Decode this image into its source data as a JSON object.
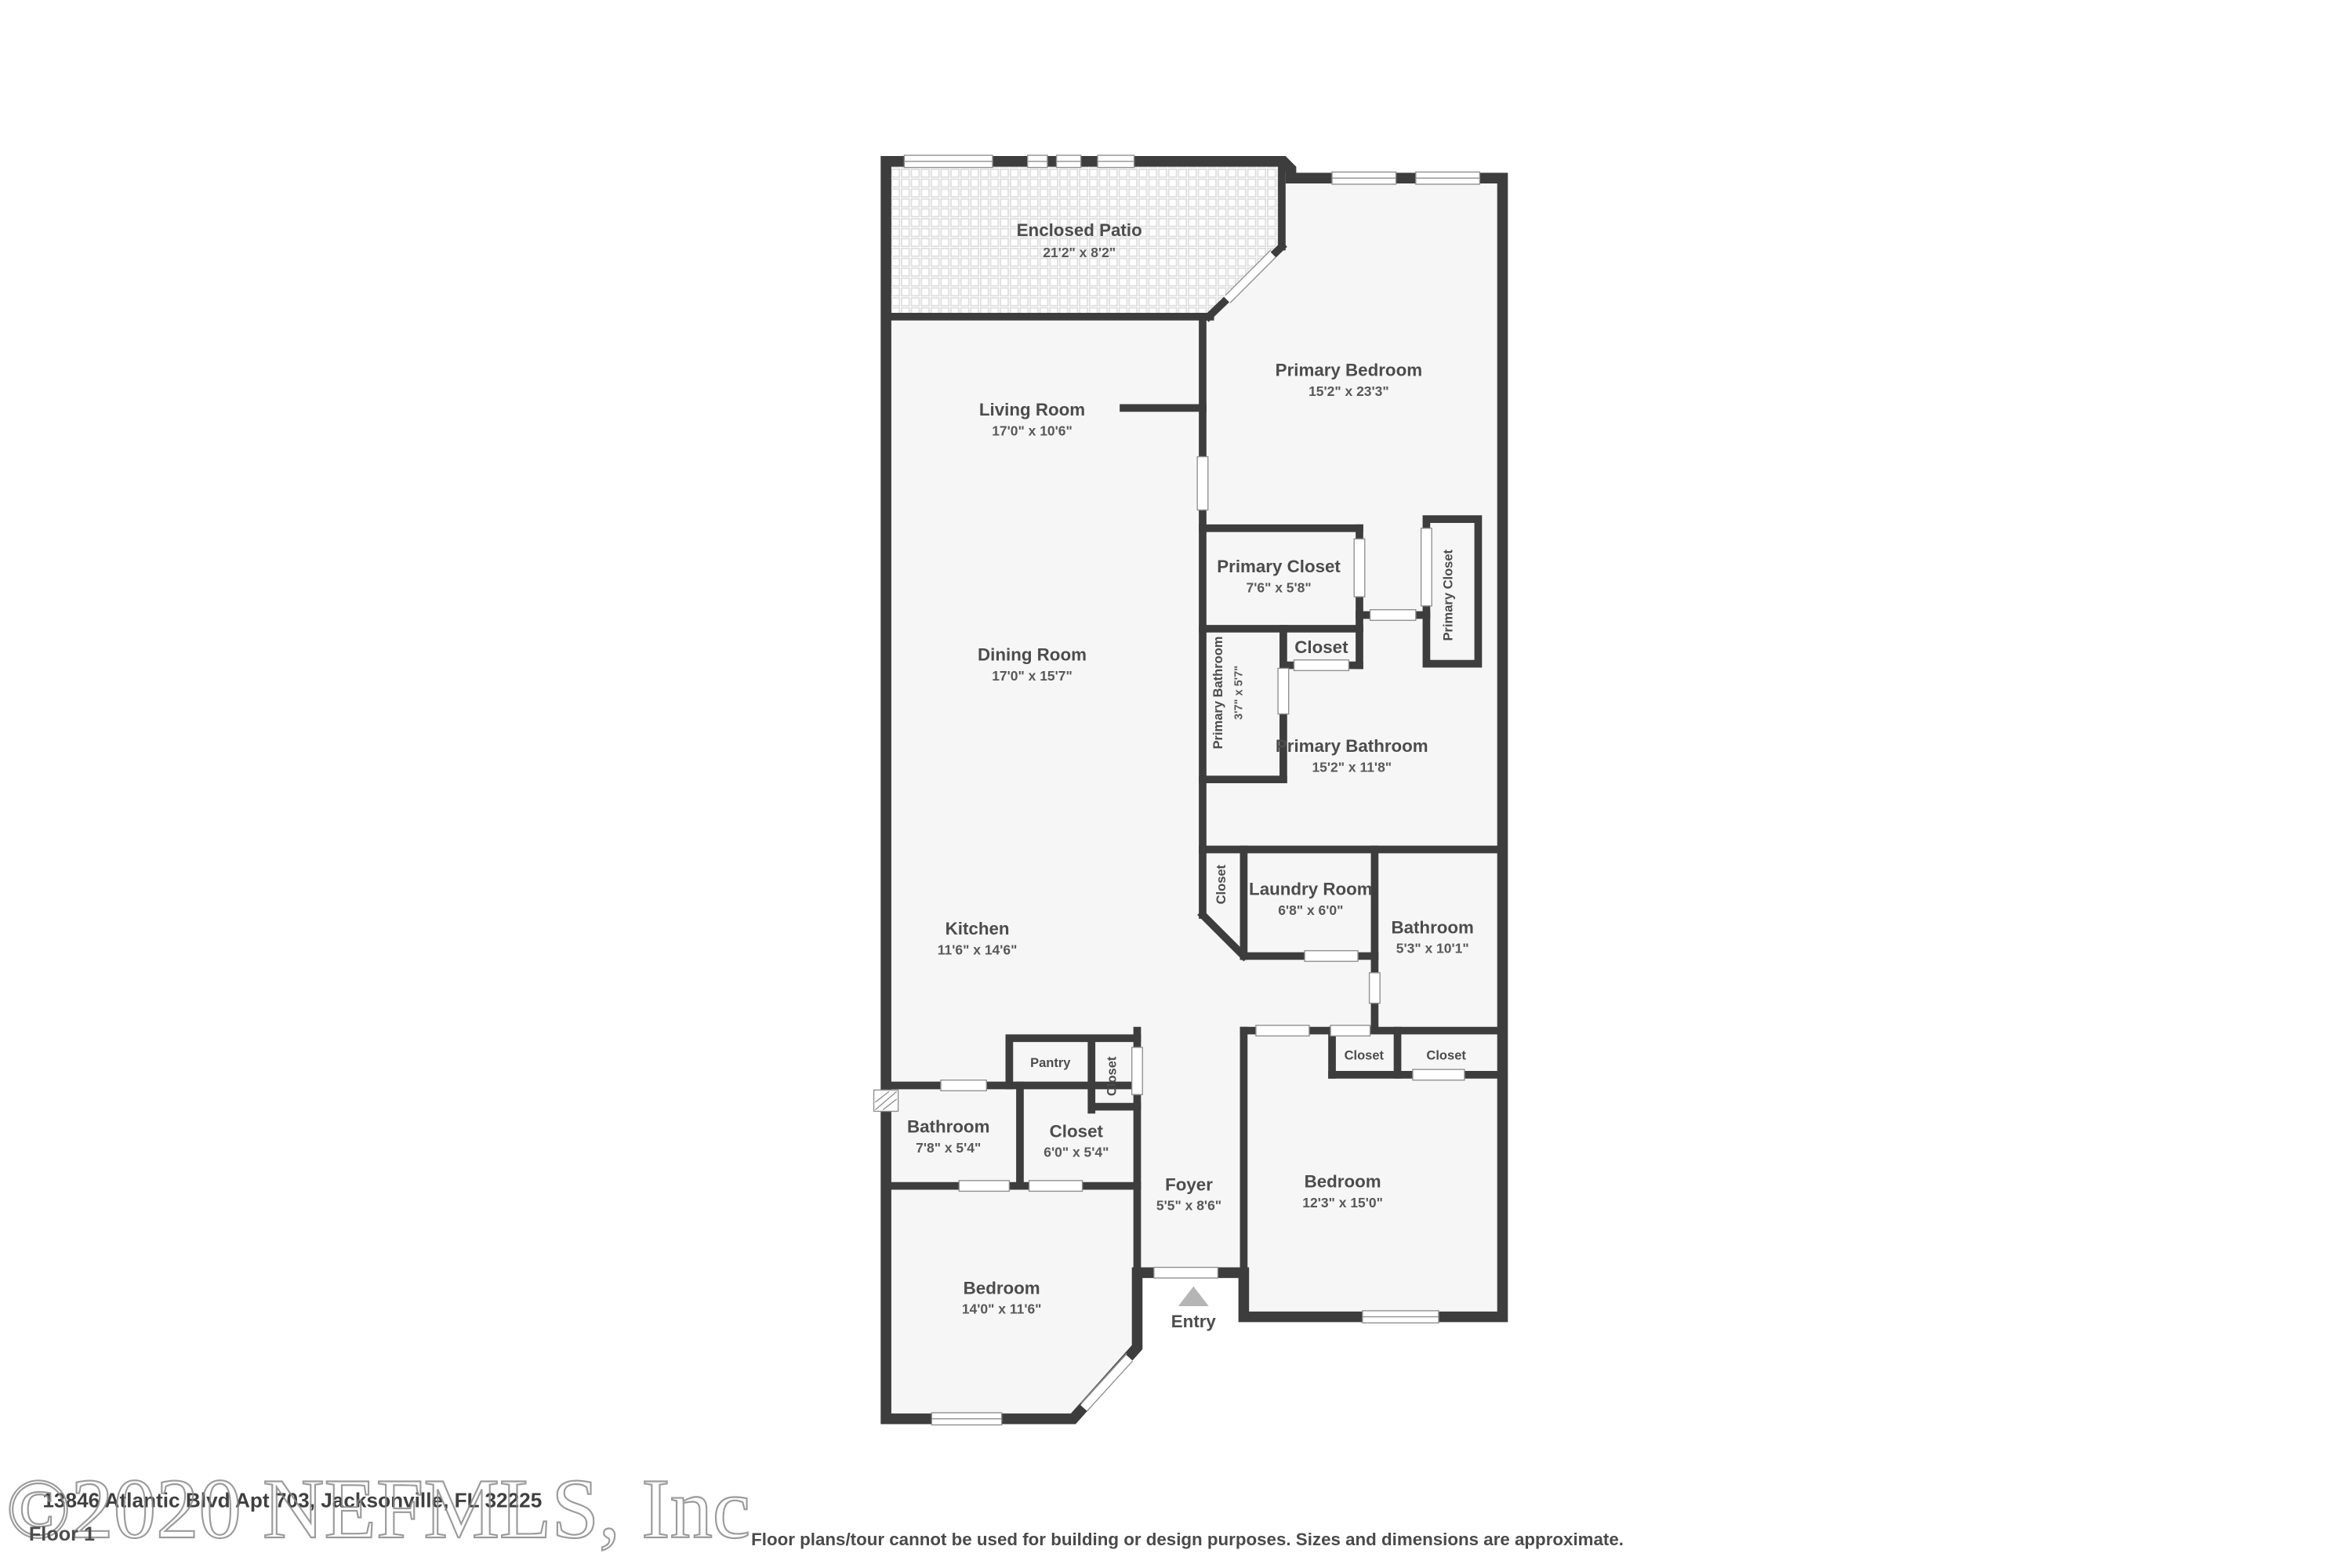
{
  "floorplan": {
    "floor_label": "Floor 1",
    "entry_label": "Entry",
    "rooms": [
      {
        "name": "Enclosed Patio",
        "dims": "21'2\" x 8'2\""
      },
      {
        "name": "Primary Bedroom",
        "dims": "15'2\" x 23'3\""
      },
      {
        "name": "Living Room",
        "dims": "17'0\" x 10'6\""
      },
      {
        "name": "Dining Room",
        "dims": "17'0\" x 15'7\""
      },
      {
        "name": "Primary Closet",
        "dims": "7'6\" x 5'8\""
      },
      {
        "name": "Primary Closet",
        "dims": ""
      },
      {
        "name": "Closet",
        "dims": ""
      },
      {
        "name": "Primary Bathroom",
        "dims": "3'7\" x 5'7\""
      },
      {
        "name": "Primary Bathroom",
        "dims": "15'2\" x 11'8\""
      },
      {
        "name": "Closet",
        "dims": ""
      },
      {
        "name": "Laundry Room",
        "dims": "6'8\" x 6'0\""
      },
      {
        "name": "Bathroom",
        "dims": "5'3\" x 10'1\""
      },
      {
        "name": "Kitchen",
        "dims": "11'6\" x 14'6\""
      },
      {
        "name": "Pantry",
        "dims": ""
      },
      {
        "name": "Closet",
        "dims": ""
      },
      {
        "name": "Closet",
        "dims": ""
      },
      {
        "name": "Closet",
        "dims": ""
      },
      {
        "name": "Bathroom",
        "dims": "7'8\" x 5'4\""
      },
      {
        "name": "Closet",
        "dims": "6'0\" x 5'4\""
      },
      {
        "name": "Foyer",
        "dims": "5'5\" x 8'6\""
      },
      {
        "name": "Bedroom",
        "dims": "12'3\" x 15'0\""
      },
      {
        "name": "Bedroom",
        "dims": "14'0\" x 11'6\""
      }
    ]
  },
  "footer": {
    "address": "13846 Atlantic Blvd Apt 703, Jacksonville, FL 32225",
    "floor_label": "Floor 1",
    "disclaimer": "Floor plans/tour cannot be used for building or design purposes. Sizes and dimensions are approximate.",
    "watermark": "©2020 NEFMLS, Inc"
  },
  "colors": {
    "wall": "#3d3d3d",
    "floor": "#f6f6f6",
    "label": "#4c4c4c",
    "watermark": "#8a8a8a",
    "entry_marker": "#b5b5b5"
  }
}
